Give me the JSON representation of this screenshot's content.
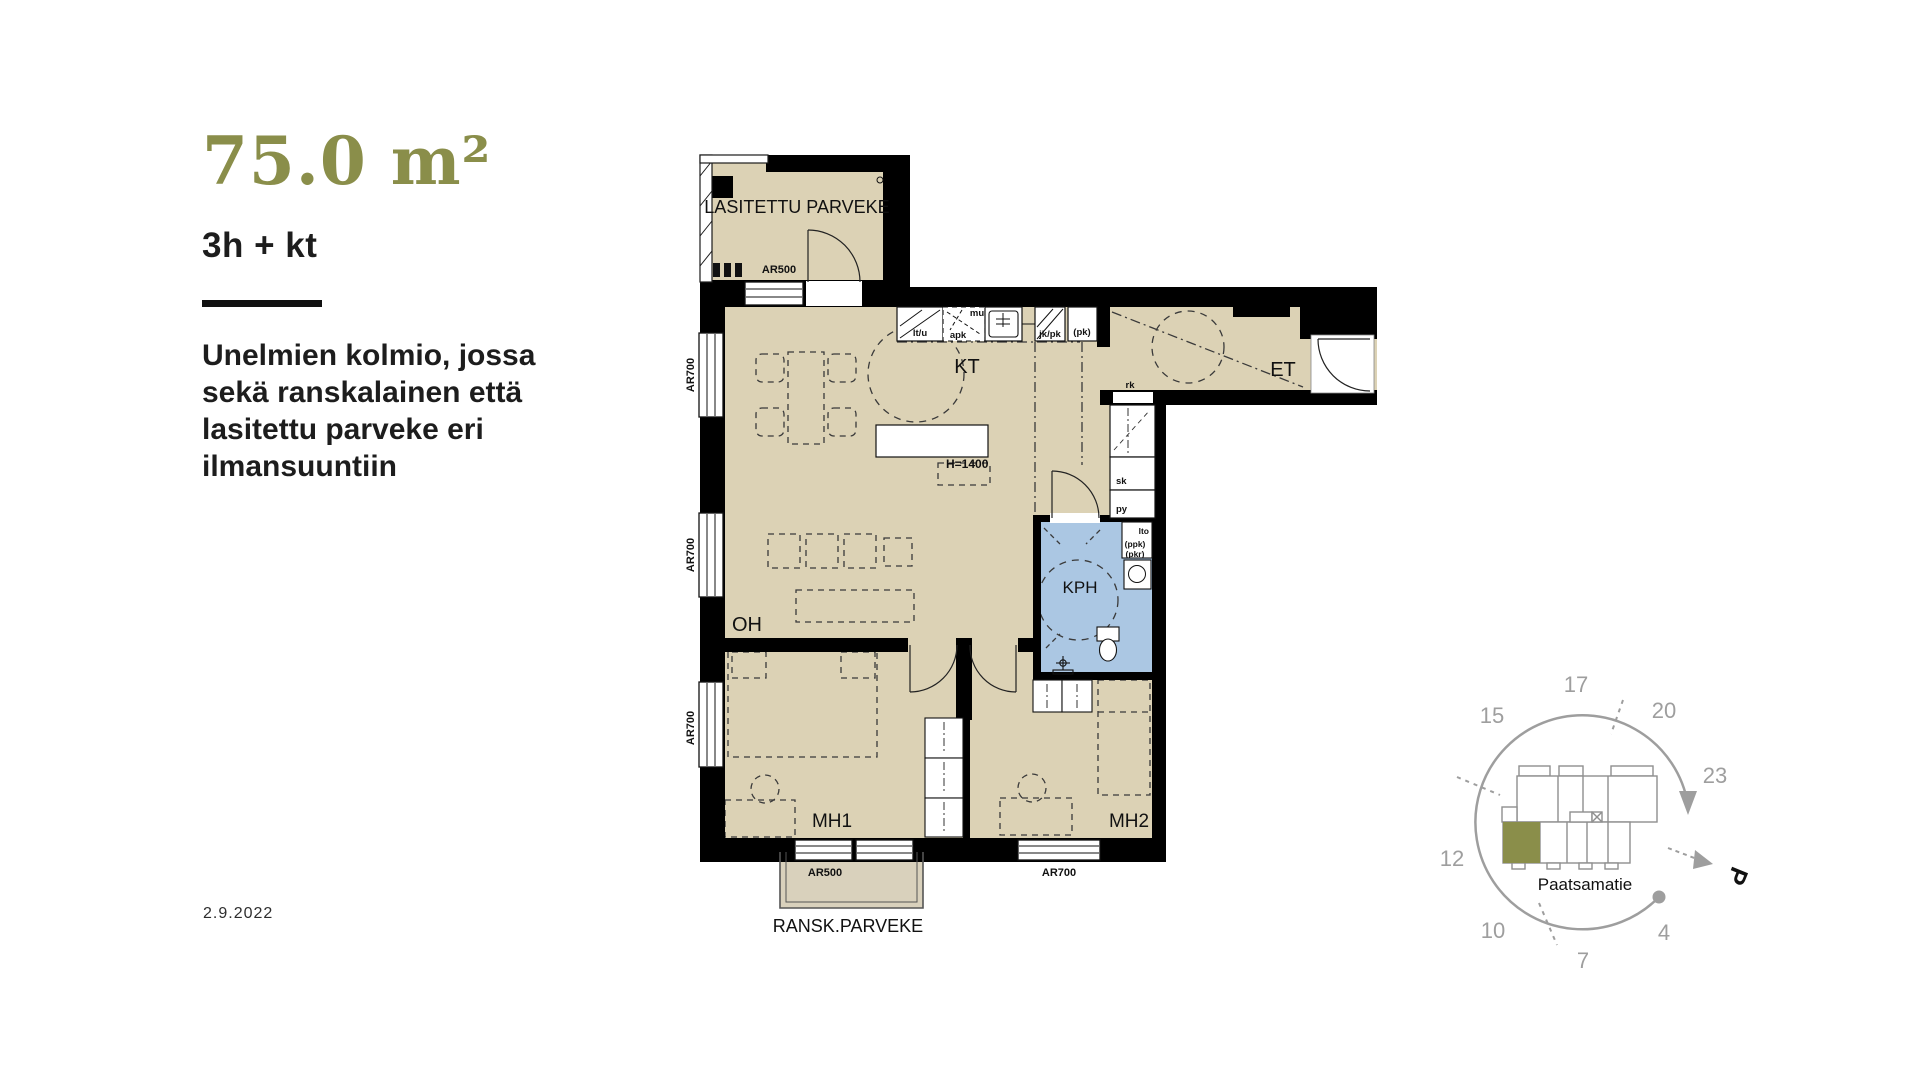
{
  "header": {
    "area": "75.0 m²",
    "room_config": "3h + kt",
    "description_lines": [
      "Unelmien kolmio, jossa",
      "sekä ranskalainen että",
      "lasitettu parveke eri",
      "ilmansuuntiin"
    ],
    "date": "2.9.2022"
  },
  "colors": {
    "accent_olive": "#8a8e4a",
    "floor_beige": "#dcd2b5",
    "bathroom_blue": "#abc7e3",
    "wall_black": "#000000",
    "siteplan_gray": "#9e9e9e"
  },
  "floorplan": {
    "rooms": {
      "glazed_balcony": "LASITETTU PARVEKE",
      "kitchen": "KT",
      "entry": "ET",
      "living_room": "OH",
      "bedroom_1": "MH1",
      "bedroom_2": "MH2",
      "bathroom": "KPH",
      "french_balcony": "RANSK.PARVEKE"
    },
    "window_labels": {
      "ar500": "AR500",
      "ar700": "AR700"
    },
    "fixture_labels": {
      "lt_u": "lt/u",
      "apk": "apk",
      "mu": "mu",
      "jk_pk": "jk/pk",
      "pk": "(pk)",
      "h1400": "H=1400",
      "rk": "rk",
      "sk": "sk",
      "py": "py",
      "lto": "lto",
      "ppk": "(ppk)",
      "pkr": "(pkr)"
    }
  },
  "siteplan": {
    "clock_numbers": [
      "17",
      "20",
      "23",
      "4",
      "7",
      "10",
      "12",
      "15"
    ],
    "street_name": "Paatsamatie",
    "north_marker": "P"
  }
}
